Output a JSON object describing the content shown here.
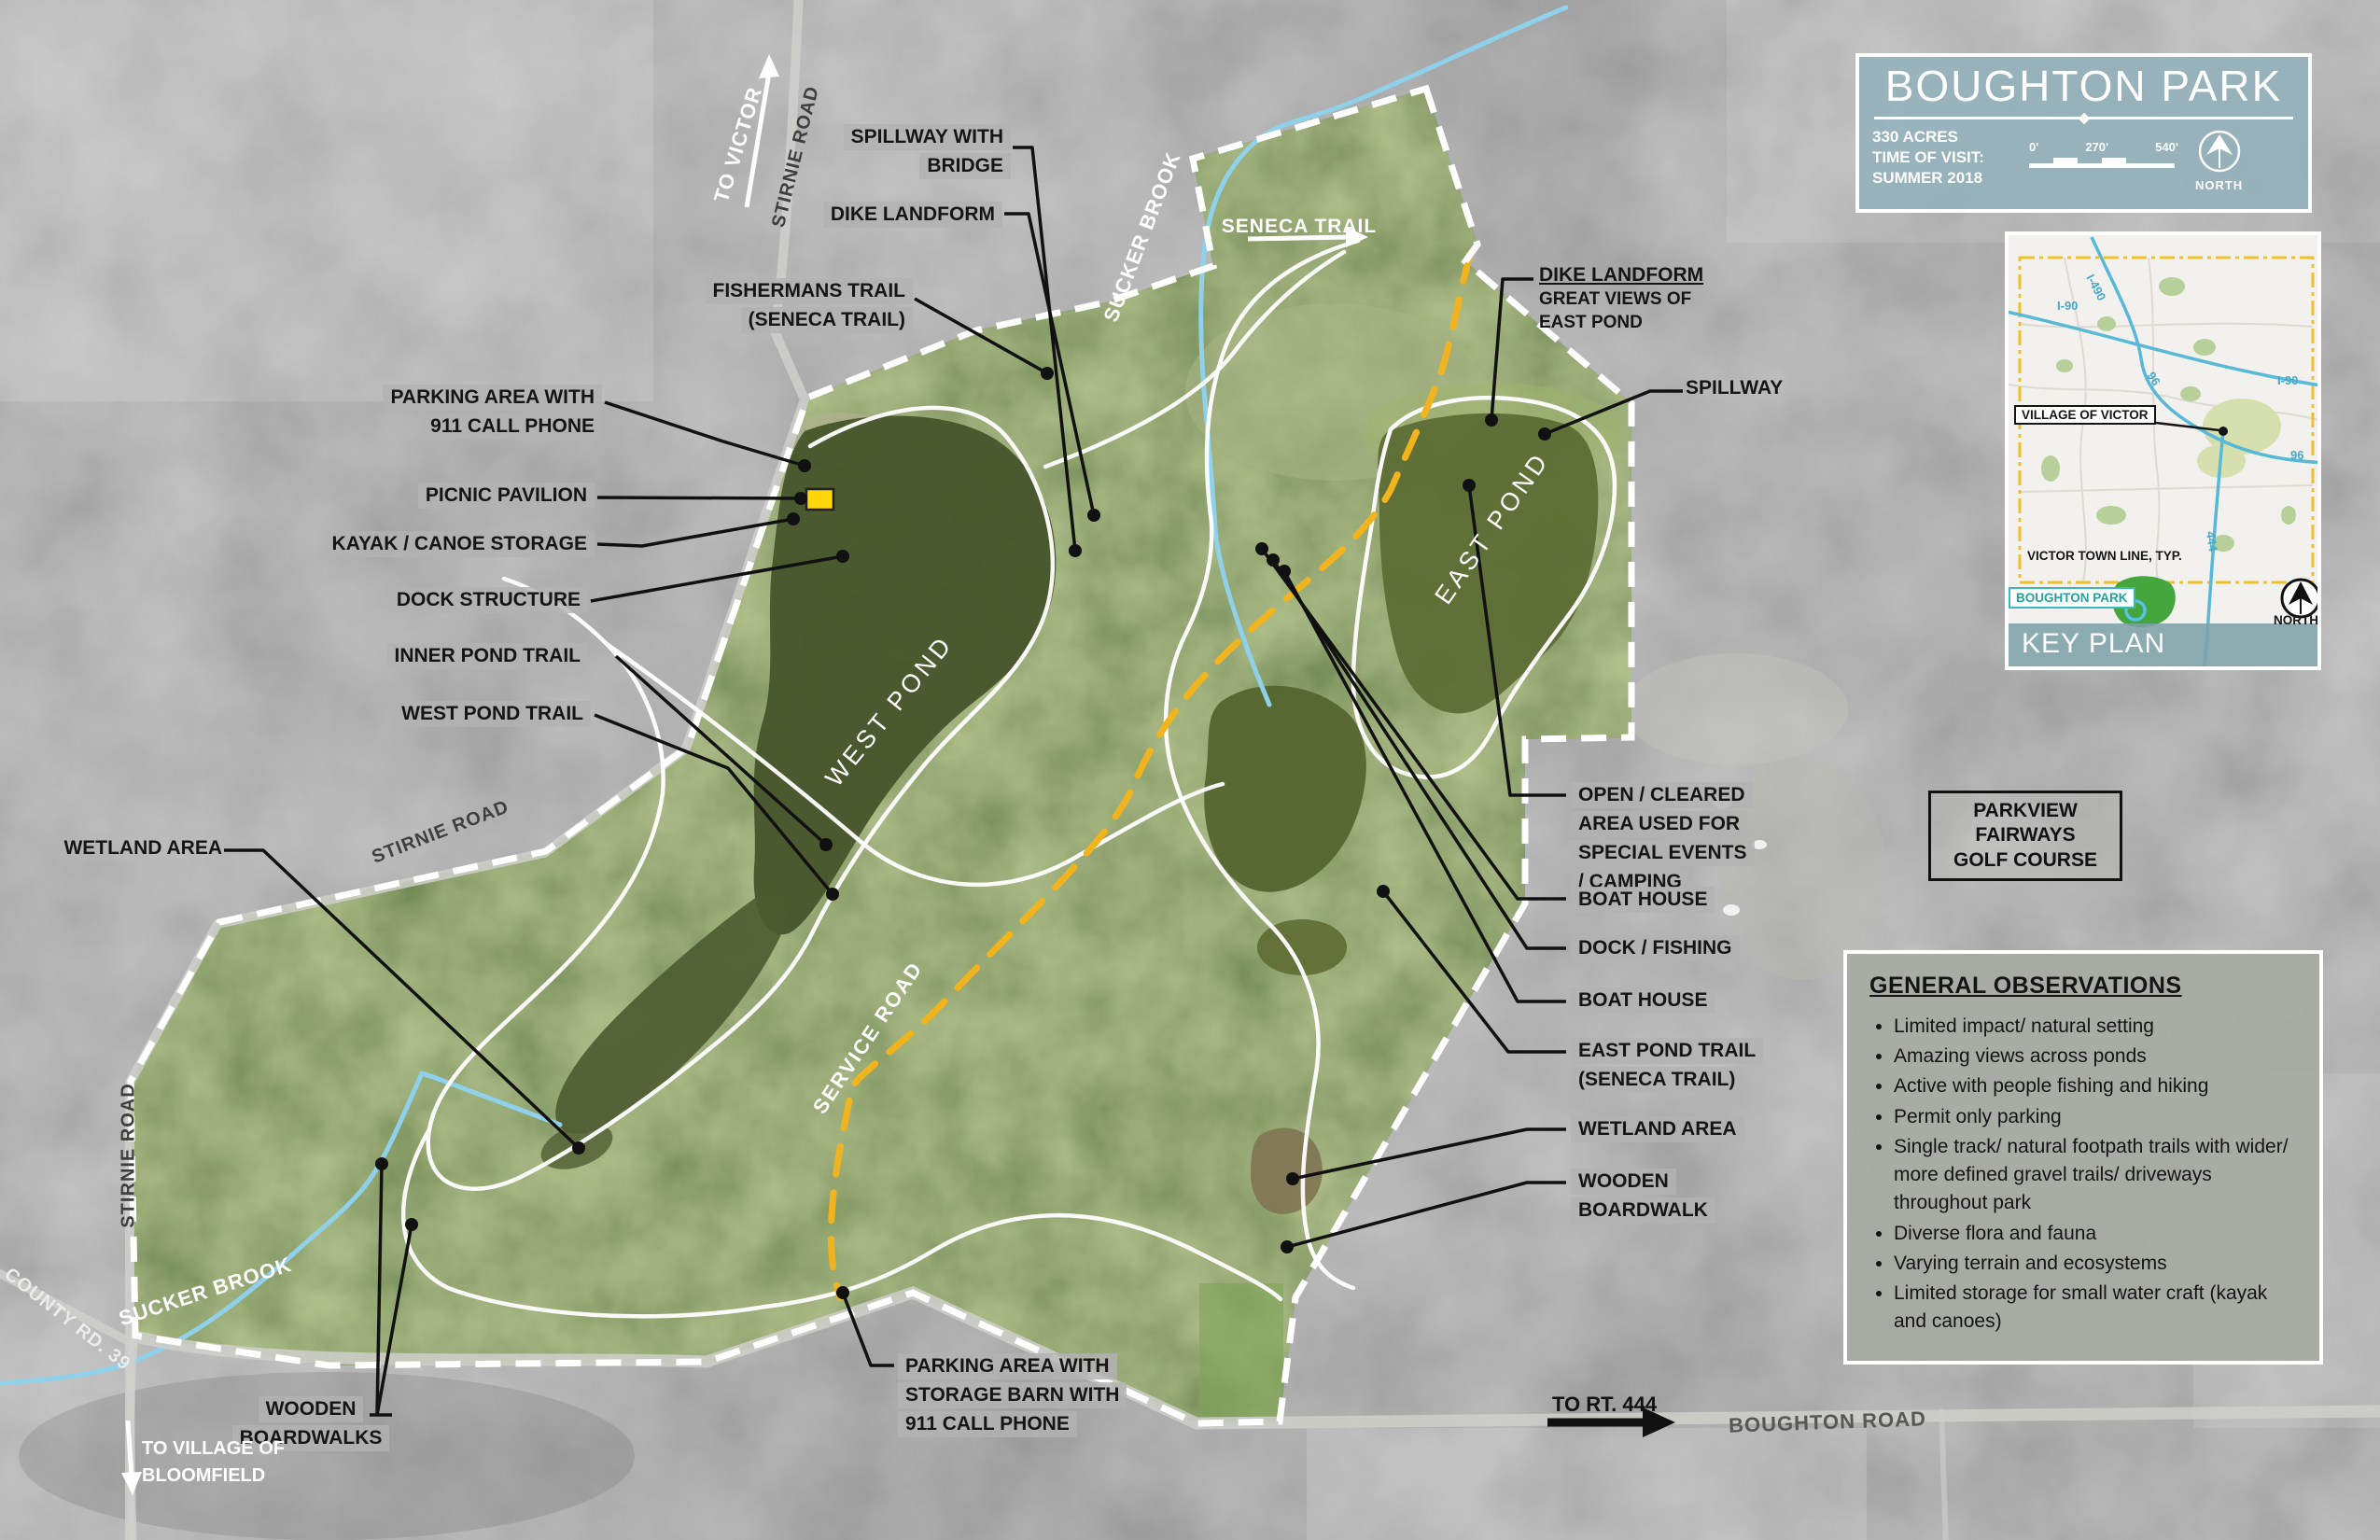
{
  "title_block": {
    "title": "BOUGHTON PARK",
    "acres": "330 ACRES",
    "visit_label": "TIME OF VISIT:",
    "visit_value": "SUMMER 2018",
    "scale_ticks": [
      "0'",
      "270'",
      "540'"
    ],
    "north_label": "NORTH"
  },
  "key_plan": {
    "title": "KEY PLAN",
    "village_label": "VILLAGE OF VICTOR",
    "town_line_label": "VICTOR TOWN LINE, TYP.",
    "park_label": "BOUGHTON PARK",
    "north_label": "NORTH",
    "roads": {
      "i490": "I-490",
      "i90": "I-90",
      "r96": "96",
      "r444": "444"
    }
  },
  "observations": {
    "title": "GENERAL OBSERVATIONS",
    "items": [
      "Limited impact/ natural setting",
      "Amazing views across ponds",
      "Active with people fishing and hiking",
      "Permit only parking",
      "Single track/ natural footpath trails with wider/ more defined gravel trails/ driveways throughout park",
      "Diverse flora and fauna",
      "Varying terrain and ecosystems",
      "Limited storage for small water craft (kayak and canoes)"
    ]
  },
  "callouts": {
    "spillway_bridge": [
      "SPILLWAY WITH",
      "BRIDGE"
    ],
    "dike_landform": [
      "DIKE LANDFORM"
    ],
    "fishermans": [
      "FISHERMANS TRAIL",
      "(SENECA TRAIL)"
    ],
    "parking_911": [
      "PARKING AREA WITH",
      "911 CALL PHONE"
    ],
    "picnic": [
      "PICNIC PAVILION"
    ],
    "kayak": [
      "KAYAK / CANOE STORAGE"
    ],
    "dock_structure": [
      "DOCK STRUCTURE"
    ],
    "inner_pond_trail": [
      "INNER POND TRAIL"
    ],
    "west_pond_trail": [
      "WEST POND TRAIL"
    ],
    "wetland_area": [
      "WETLAND AREA"
    ],
    "dike_right_title": "DIKE LANDFORM",
    "dike_right_sub": [
      "GREAT VIEWS OF",
      "EAST POND"
    ],
    "spillway": [
      "SPILLWAY"
    ],
    "open_cleared": [
      "OPEN / CLEARED",
      "AREA USED FOR",
      "SPECIAL EVENTS",
      "/ CAMPING"
    ],
    "boat_house": [
      "BOAT HOUSE"
    ],
    "dock_fishing": [
      "DOCK / FISHING"
    ],
    "east_pond_trail": [
      "EAST POND TRAIL",
      "(SENECA TRAIL)"
    ],
    "wooden_boardwalk": [
      "WOODEN",
      "BOARDWALK"
    ],
    "wooden_boardwalks": [
      "WOODEN",
      "BOARDWALKS"
    ],
    "parking_storage": [
      "PARKING AREA WITH",
      "STORAGE BARN WITH",
      "911 CALL PHONE"
    ],
    "golf": [
      "PARKVIEW",
      "FAIRWAYS",
      "GOLF COURSE"
    ]
  },
  "place_labels": {
    "west_pond": "WEST POND",
    "east_pond": "EAST POND",
    "service_road": "SERVICE ROAD",
    "seneca_trail": "SENECA TRAIL",
    "sucker_brook": "SUCKER BROOK",
    "stirnie_road": "STIRNIE ROAD",
    "county_rd": "COUNTY RD. 39",
    "boughton_road": "BOUGHTON ROAD",
    "to_victor": "TO VICTOR",
    "to_rt444": "TO RT. 444",
    "to_bloomfield": [
      "TO VILLAGE OF",
      "BLOOMFIELD"
    ]
  },
  "colors": {
    "title_panel": "#94b1ba",
    "label_bg": "#b2b2b2",
    "park_boundary": "#ffffff",
    "service_road_dash": "#f2b41e",
    "brook": "#8fd0ea",
    "pond": "#4e5e33",
    "keyplan_highway": "#57b8d8",
    "keyplan_park_green": "#44a63d",
    "keyplan_teal": "#3cb6c0",
    "picnic_marker": "#ffd60a"
  }
}
